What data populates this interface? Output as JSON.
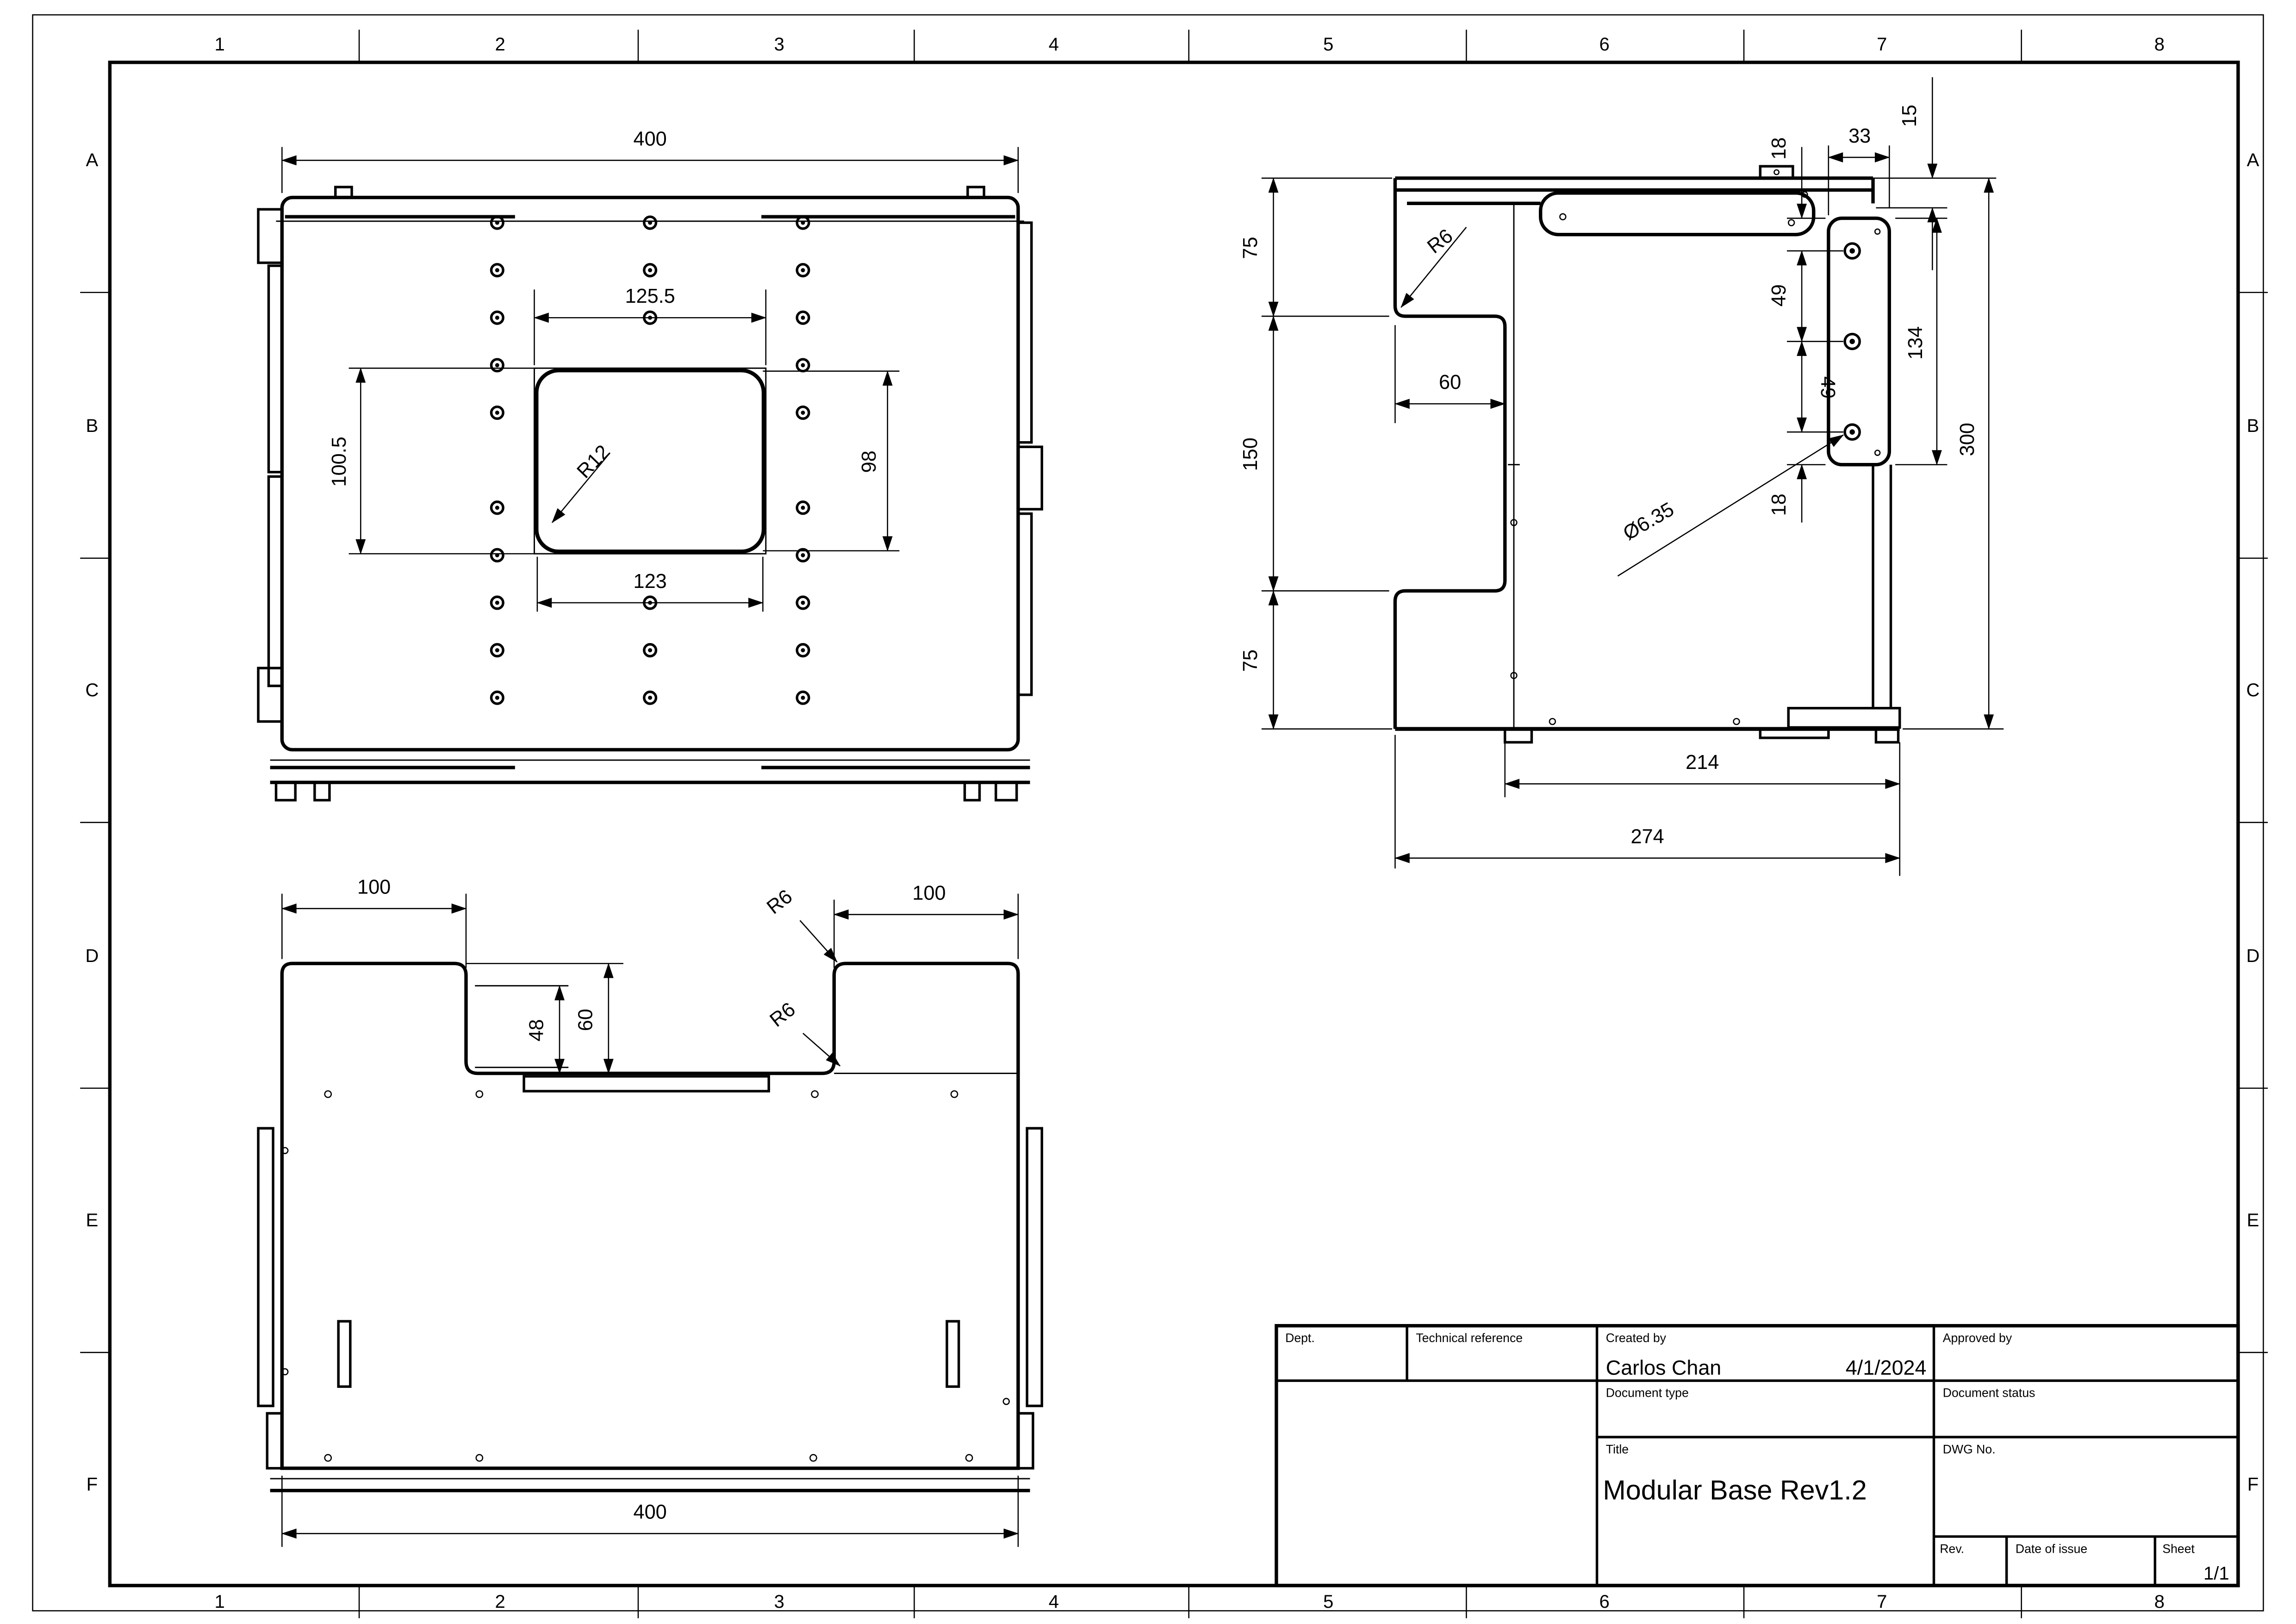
{
  "sheet": {
    "cols": [
      "1",
      "2",
      "3",
      "4",
      "5",
      "6",
      "7",
      "8"
    ],
    "rows": [
      "A",
      "B",
      "C",
      "D",
      "E",
      "F"
    ]
  },
  "title_block": {
    "dept_label": "Dept.",
    "technical_reference_label": "Technical reference",
    "created_by_label": "Created by",
    "created_by_value": "Carlos Chan",
    "created_date": "4/1/2024",
    "approved_by_label": "Approved by",
    "document_type_label": "Document type",
    "document_status_label": "Document status",
    "title_label": "Title",
    "title_value": "Modular Base Rev1.2",
    "dwg_no_label": "DWG No.",
    "rev_label": "Rev.",
    "date_of_issue_label": "Date of issue",
    "sheet_label": "Sheet",
    "sheet_value": "1/1"
  },
  "views": {
    "top": {
      "dims": {
        "width": "400",
        "cutout_top": "125.5",
        "cutout_left": "100.5",
        "cutout_right": "98",
        "cutout_bottom": "123",
        "corner_radius": "R12"
      }
    },
    "side": {
      "dims": {
        "seg_top": "75",
        "seg_mid": "150",
        "seg_bottom": "75",
        "notch_depth": "60",
        "notch_fillet": "R6",
        "edge_gap": "18",
        "plate_width": "33",
        "plate_offset": "15",
        "hole_top": "18",
        "hole_pitch_1": "49",
        "hole_pitch_2": "49",
        "hole_bottom": "18",
        "plate_height": "134",
        "overall_height": "300",
        "hole_diameter": "Ø6.35",
        "inner_width": "214",
        "overall_width": "274"
      }
    },
    "front": {
      "dims": {
        "tab_left": "100",
        "tab_right": "100",
        "notch_inner": "48",
        "notch_depth": "60",
        "fillet_top": "R6",
        "fillet_bottom": "R6",
        "width": "400"
      }
    }
  }
}
